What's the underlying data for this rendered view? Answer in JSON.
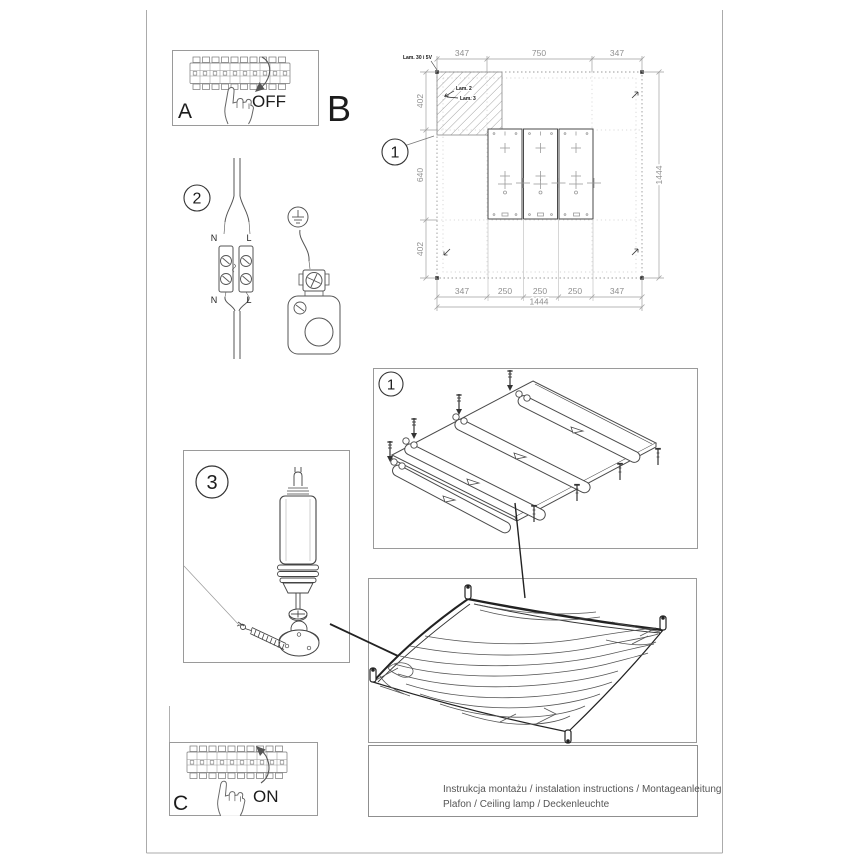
{
  "steps": {
    "a_label": "A",
    "a_action": "OFF",
    "b_label": "B",
    "c_label": "C",
    "c_action": "ON",
    "step1": "1",
    "step2": "2",
    "step3": "3",
    "iso_step": "1"
  },
  "drawing": {
    "top_dims": [
      "347",
      "750",
      "347"
    ],
    "left_dims": [
      "402",
      "640",
      "402"
    ],
    "right_dim": "1444",
    "bottom_dims": [
      "347",
      "250",
      "250",
      "250",
      "347"
    ],
    "bottom_total": "1444",
    "anchor_note": "Lam. 30 i 5V",
    "hatch_labels": [
      "Lam. 2",
      "Lam. 3"
    ]
  },
  "wiring": {
    "top_n": "N",
    "top_l": "L",
    "bottom_n": "N",
    "bottom_l": "L"
  },
  "footer": {
    "line1": "Instrukcja montażu / instalation instructions / Montageanleitung",
    "line2": "Plafon / Ceiling lamp / Deckenleuchte"
  },
  "colors": {
    "ink": "#333333",
    "dim_line": "#8f8f8f",
    "panel_border": "#9a9a9a",
    "page_border": "#ababab"
  }
}
